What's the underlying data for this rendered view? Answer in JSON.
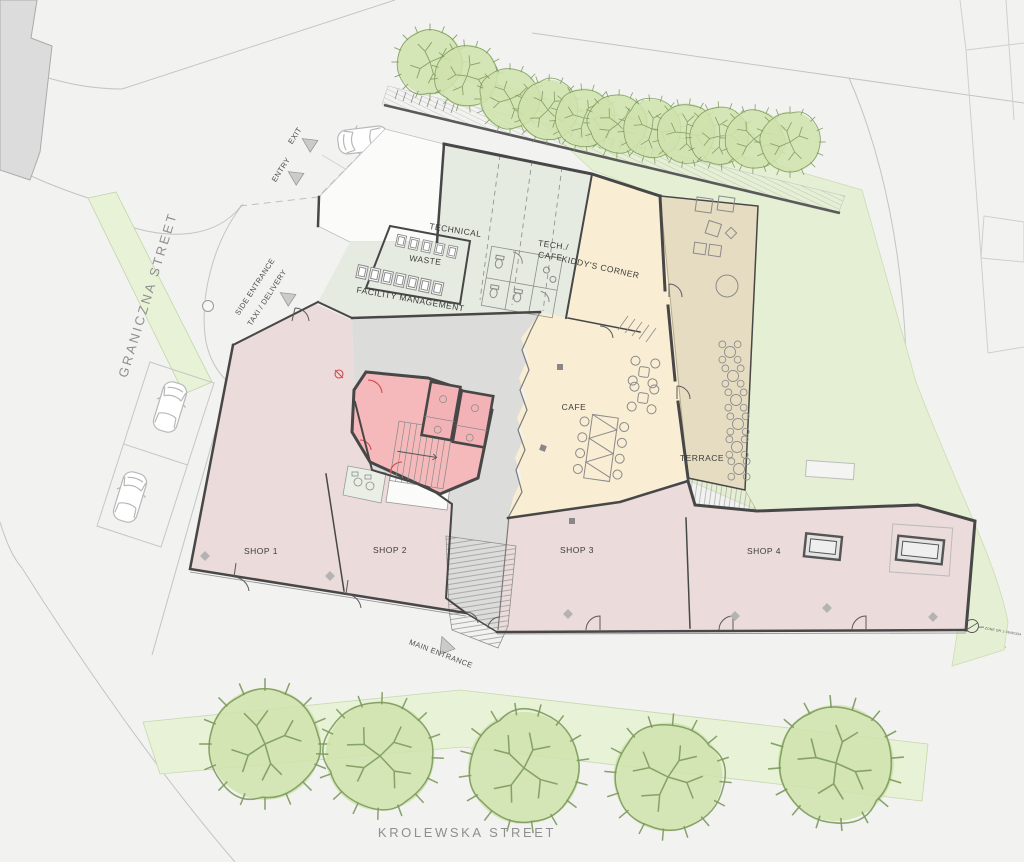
{
  "streets": {
    "left_vertical": "GRANICZNA STREET",
    "bottom": "KROLEWSKA STREET"
  },
  "entrances": {
    "entry": "ENTRY",
    "exit": "EXIT",
    "side_line1": "SIDE ENTRANCE",
    "side_line2": "TAXI / DELIVERY",
    "main": "MAIN ENTRANCE"
  },
  "rooms": {
    "technical": "TECHNICAL",
    "waste": "WASTE",
    "facility_management": "FACILITY MANAGEMENT",
    "tech_cafe_line1": "TECH./",
    "tech_cafe_line2": "CAFE",
    "kiddys_corner": "KIDDY'S CORNER",
    "cafe": "CAFE",
    "terrace": "TERRACE",
    "shop1": "SHOP 1",
    "shop2": "SHOP 2",
    "shop3": "SHOP 3",
    "shop4": "SHOP 4"
  },
  "annotations": {
    "zone_note": "ZONE DR 1-3848/334"
  },
  "colors": {
    "street_bg": "#f2f2f1",
    "road_line": "#c4c4c4",
    "neighbor_fill": "#dcdcdc",
    "lawn": "#e4efd3",
    "green_strip": "#e7f2d6",
    "tree_fill": "#cfe3ad",
    "tree_stroke": "#7d9a5e",
    "mint": "#e5ebe1",
    "cream": "#f9eed3",
    "tan": "#e6dcc1",
    "pink": "#ecdbdb",
    "core_pink": "#f6b9bb",
    "corridor": "#dcdcdb",
    "white_room": "#fbfbfa",
    "wc_green": "#e9efe4",
    "wall": "#474747",
    "furniture": "#8b8b8b",
    "red": "#cf4a4a",
    "label": "#3c3c3c",
    "street_label": "#8f8f8f",
    "marker": "#cbcbcb",
    "car": "#b8b8b8"
  }
}
